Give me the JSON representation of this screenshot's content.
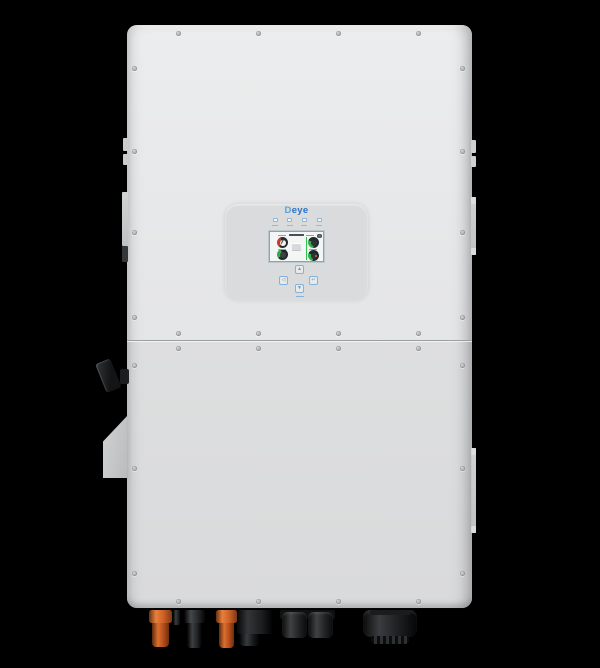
{
  "scene": {
    "type": "product-photo",
    "subject": "Deye hybrid solar inverter, front view",
    "background_color": "#000000"
  },
  "device": {
    "brand": "Deye",
    "body_color": "#e5e6e7",
    "display_panel": {
      "logo_text": "Deye",
      "logo_color": "#2b72c8",
      "status_led_count": 4,
      "screen": {
        "icons": [
          "gear-icon",
          "energy-flow-icon"
        ],
        "gauges": [
          {
            "position": "top-left",
            "arc_color": "#c23b2c"
          },
          {
            "position": "top-right",
            "arc_color": "#2fae47"
          },
          {
            "position": "bottom-left",
            "arc_color": "#2fae47"
          },
          {
            "position": "bottom-right",
            "arc_color": "#2fae47"
          }
        ],
        "flow_line_color": "#2fc24f"
      },
      "buttons": [
        {
          "id": "up",
          "glyph": "▲"
        },
        {
          "id": "esc",
          "glyph": "◁"
        },
        {
          "id": "enter",
          "glyph": "↵"
        },
        {
          "id": "down",
          "glyph": "▼"
        }
      ],
      "button_color": "#85b2d6"
    },
    "left_side": {
      "dc_switch_color": "#1d1f21",
      "bracket_color": "#c6c8c9"
    },
    "bottom_connectors": [
      {
        "type": "mc4-pv-connector",
        "color": "orange"
      },
      {
        "type": "mc4-pv-connector",
        "color": "black"
      },
      {
        "type": "mc4-pv-connector",
        "color": "orange"
      },
      {
        "type": "connector-block",
        "color": "black"
      },
      {
        "type": "cable-gland",
        "color": "black"
      },
      {
        "type": "cable-gland",
        "color": "black"
      },
      {
        "type": "large-cable-gland",
        "color": "black"
      }
    ],
    "hardware": {
      "screw_color": "#a8aaac"
    }
  }
}
